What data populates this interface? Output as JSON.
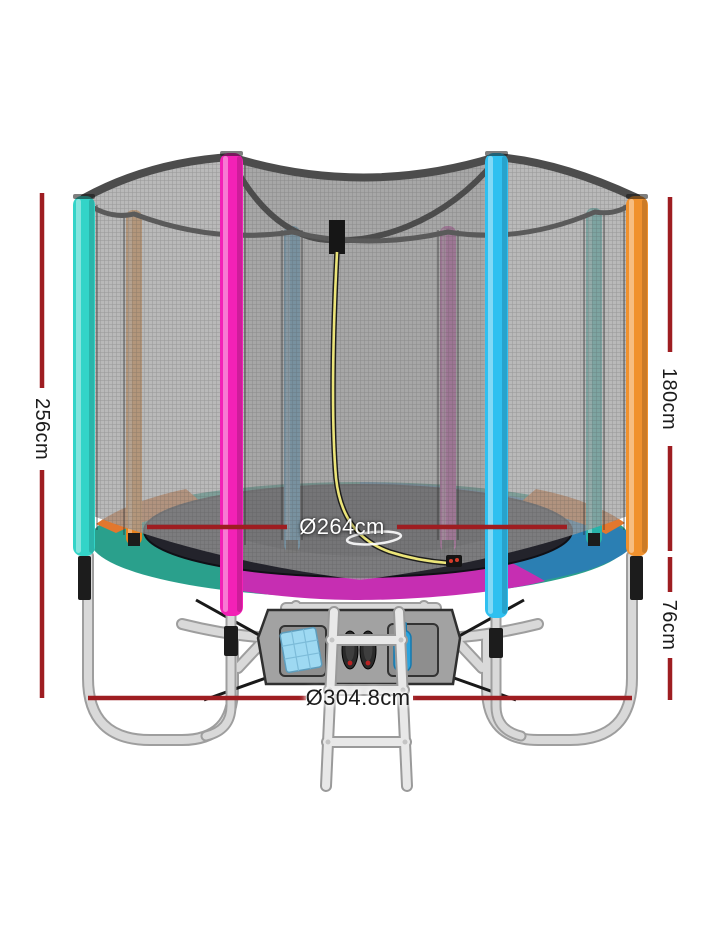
{
  "page": {
    "background": "#ffffff",
    "type": "product-dimension-diagram",
    "subject": "trampoline-with-safety-net-and-ladder"
  },
  "annotations": {
    "total_height": "256cm",
    "net_height": "180cm",
    "frame_height": "76cm",
    "mat_diameter": "Ø264cm",
    "outer_diameter": "Ø304.8cm",
    "line_color": "#9e1d21",
    "label_color": "#1b1b1b",
    "mat_label_color": "#ffffff"
  },
  "colors": {
    "mat": "#23232b",
    "pad_teal": "#2aa08c",
    "pad_magenta": "#c62eb2",
    "pad_blue": "#2b7fb3",
    "pad_orange": "#e2772e",
    "pole_teal": "#33d4c8",
    "pole_orange_back": "#e8831f",
    "pole_magenta": "#f321b6",
    "pole_blue": "#2e9ddc",
    "pole_magenta_back": "#d428aa",
    "pole_cyan": "#2fc0f0",
    "pole_teal_back": "#27b3a9",
    "pole_orange": "#f0912d",
    "net_mesh": "#a0a0a0",
    "net_rim": "#4c4c4c",
    "frame_silver": "#d9d9d9",
    "zipper_yellow": "#ece579",
    "bag_gray": "#a2a2a2",
    "towel_blue": "#9ed9f2",
    "bottle_blue": "#2ba3dd",
    "shoe_dark": "#2a2a2a"
  }
}
